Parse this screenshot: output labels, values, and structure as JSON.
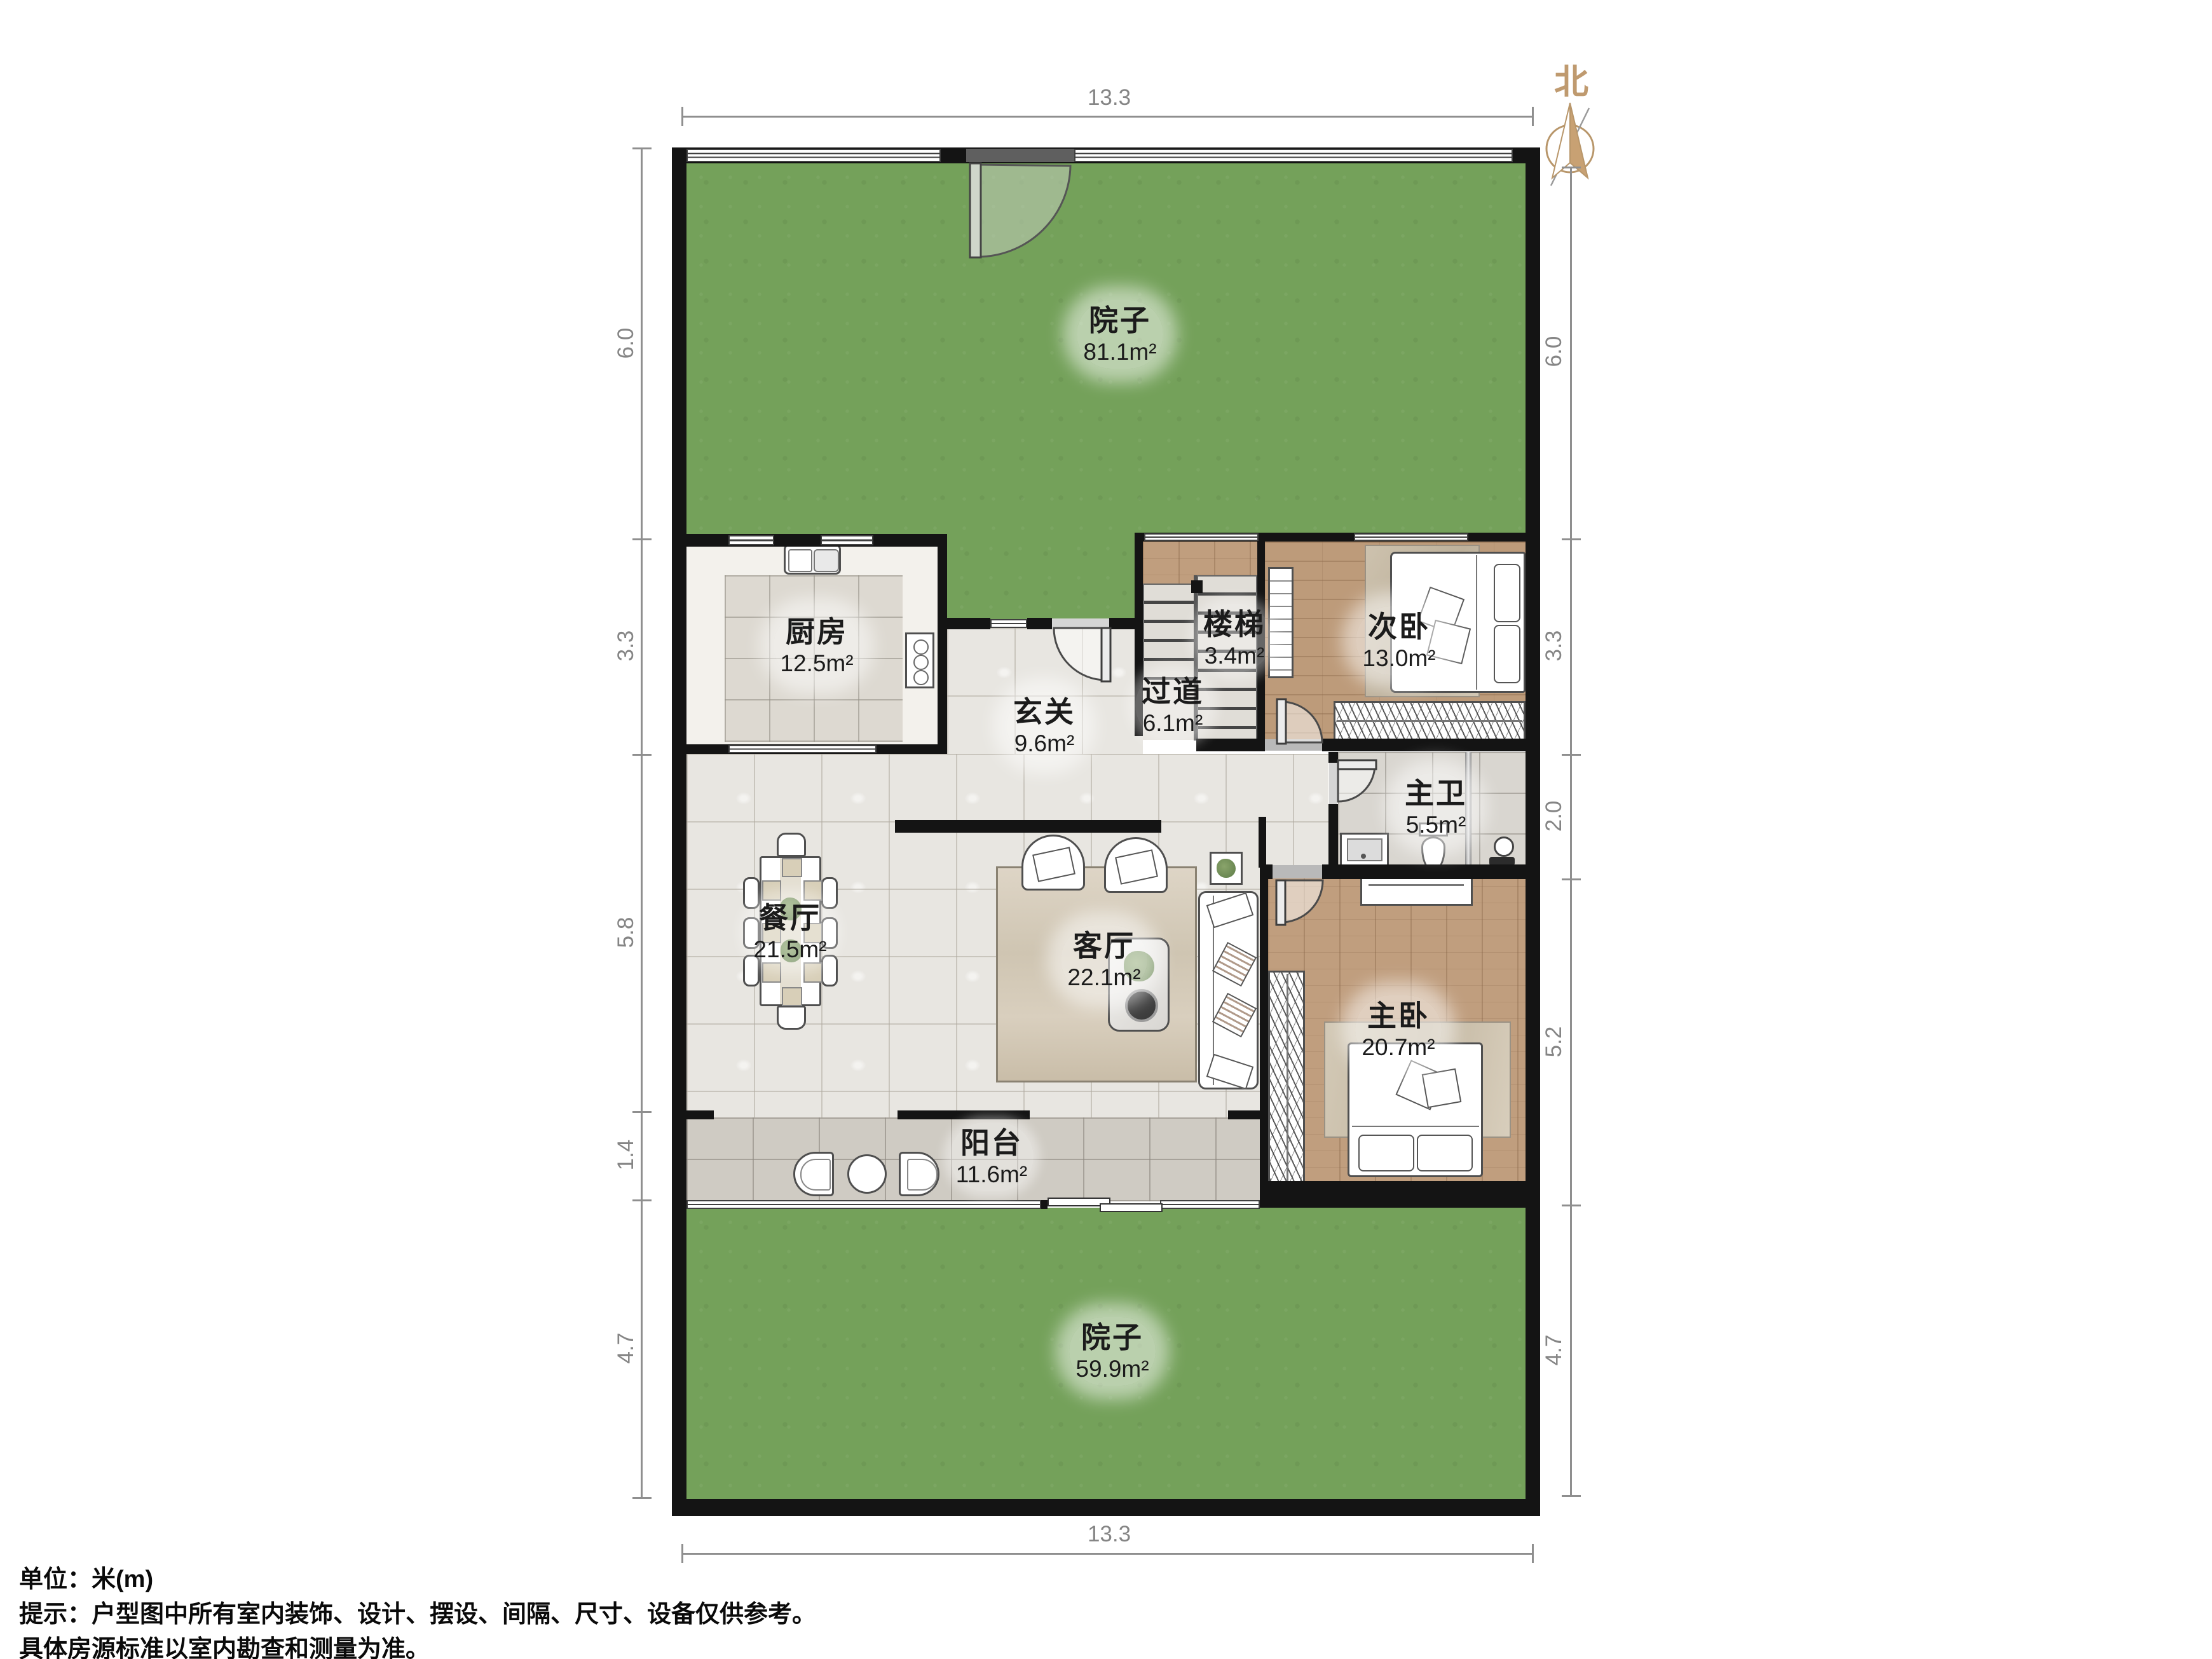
{
  "compass": {
    "north_label": "北"
  },
  "dimensions": {
    "top": "13.3",
    "bottom": "13.3",
    "left": [
      "6.0",
      "3.3",
      "5.8",
      "1.4",
      "4.7"
    ],
    "right": [
      "6.0",
      "3.3",
      "2.0",
      "5.2",
      "4.7"
    ]
  },
  "rooms": [
    {
      "name": "院子",
      "area": "81.1m²"
    },
    {
      "name": "厨房",
      "area": "12.5m²"
    },
    {
      "name": "玄关",
      "area": "9.6m²"
    },
    {
      "name": "过道",
      "area": "6.1m²"
    },
    {
      "name": "楼梯",
      "area": "3.4m²"
    },
    {
      "name": "次卧",
      "area": "13.0m²"
    },
    {
      "name": "主卫",
      "area": "5.5m²"
    },
    {
      "name": "餐厅",
      "area": "21.5m²"
    },
    {
      "name": "客厅",
      "area": "22.1m²"
    },
    {
      "name": "主卧",
      "area": "20.7m²"
    },
    {
      "name": "阳台",
      "area": "11.6m²"
    },
    {
      "name": "院子",
      "area": "59.9m²"
    }
  ],
  "footer": {
    "unit": "单位：米(m)",
    "note1": "提示：户型图中所有室内装饰、设计、摆设、间隔、尺寸、设备仅供参考。",
    "note2": "具体房源标准以室内勘查和测量为准。"
  },
  "colors": {
    "grass": "#74a15a",
    "wood": "#c09e7e",
    "marble": "#e8e6e1",
    "wall": "#141414",
    "accent": "#bf9a6f"
  }
}
